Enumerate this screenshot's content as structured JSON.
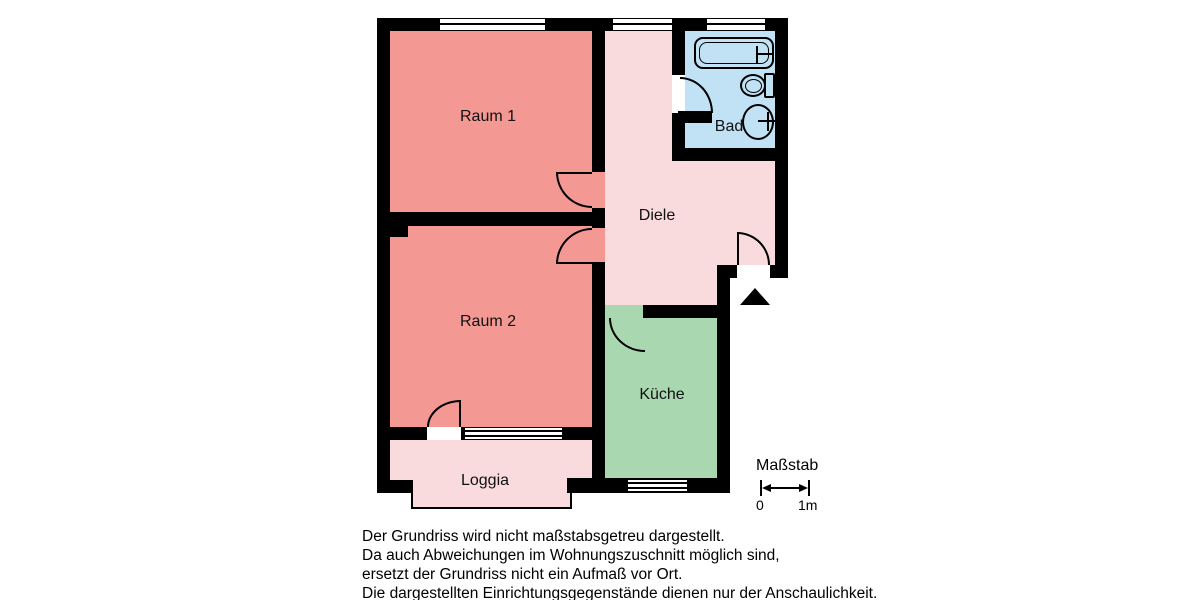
{
  "floorplan": {
    "rooms": {
      "raum1": {
        "label": "Raum 1",
        "color": "#F49894"
      },
      "raum2": {
        "label": "Raum 2",
        "color": "#F49894"
      },
      "diele": {
        "label": "Diele",
        "color": "#F9DBDD"
      },
      "bad": {
        "label": "Bad",
        "color": "#C1E1F4"
      },
      "kueche": {
        "label": "Küche",
        "color": "#A9D8B0"
      },
      "loggia": {
        "label": "Loggia",
        "color": "#F9DBDD"
      }
    },
    "wall_color": "#000000",
    "fixtures": [
      "bathtub",
      "toilet",
      "sink"
    ],
    "entrance_marker": "triangle-up-arrow"
  },
  "scale": {
    "label": "Maßstab",
    "tick_start": "0",
    "tick_end": "1m"
  },
  "disclaimer": {
    "lines": [
      "Der Grundriss wird nicht maßstabsgetreu dargestellt.",
      "Da auch Abweichungen im Wohnungszuschnitt möglich sind,",
      "ersetzt der Grundriss nicht ein Aufmaß vor Ort.",
      "Die dargestellten Einrichtungsgegenstände dienen nur der Anschaulichkeit."
    ]
  }
}
